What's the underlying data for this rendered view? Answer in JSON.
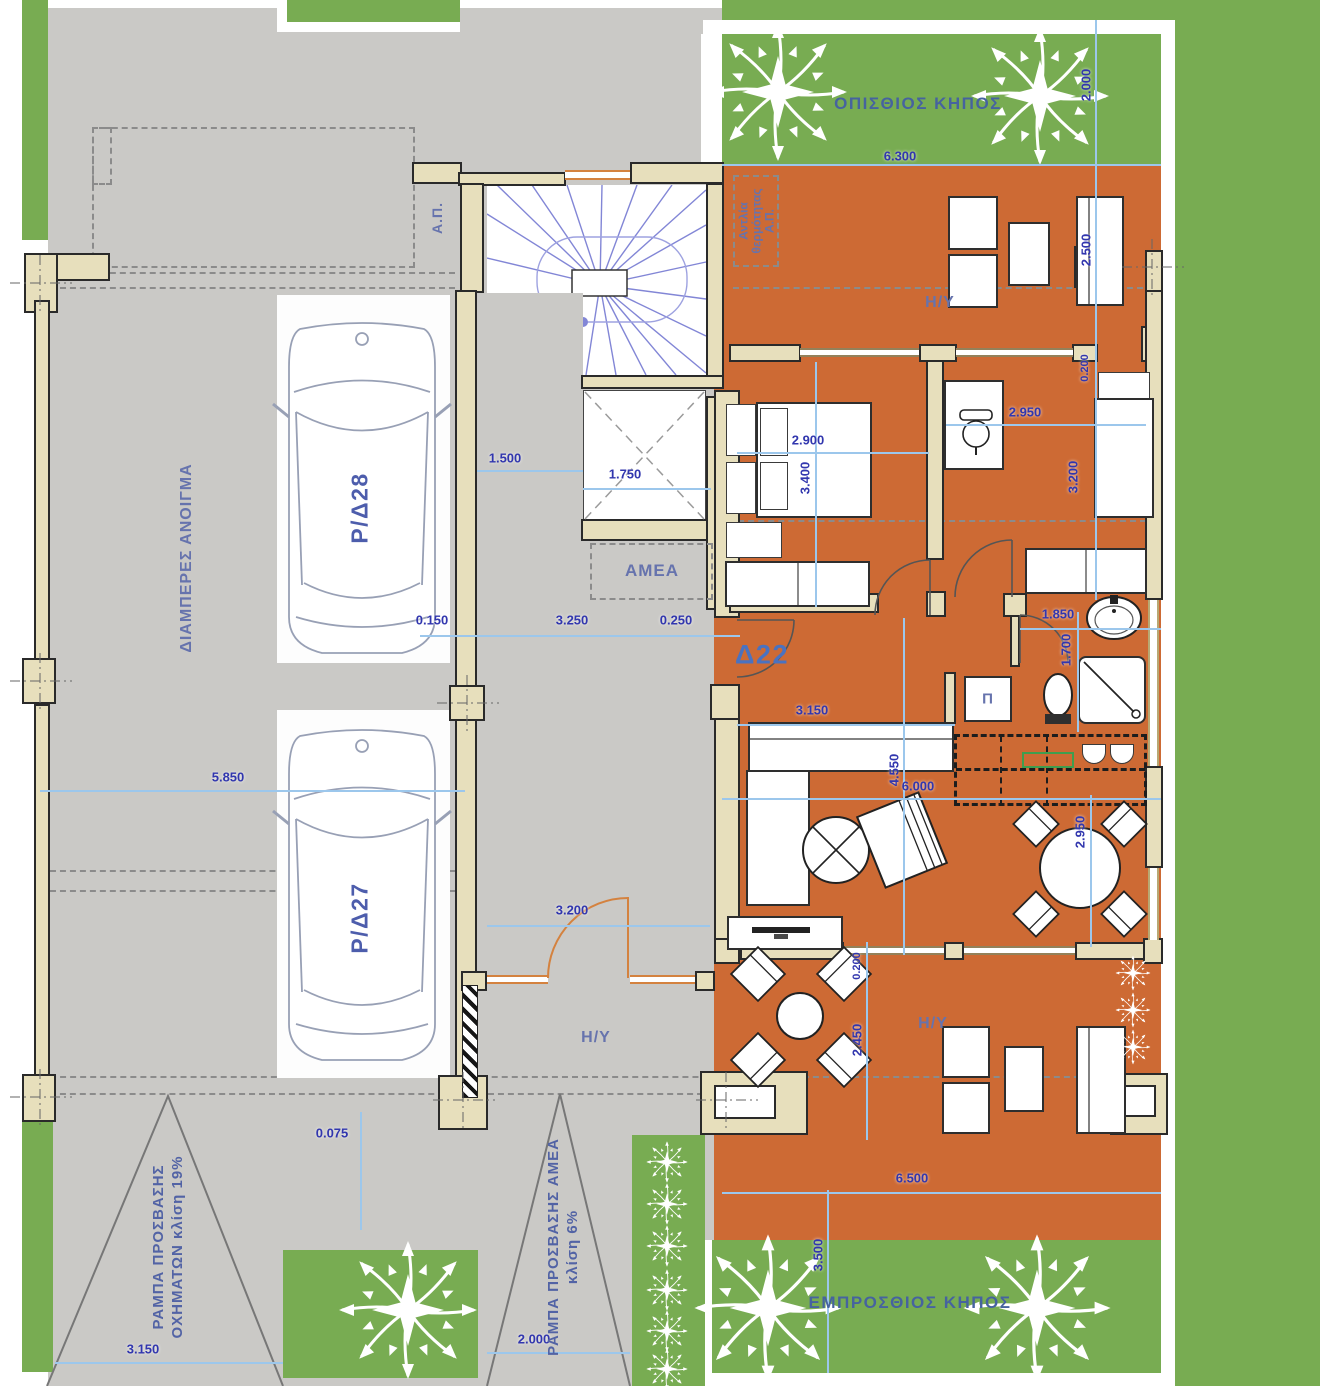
{
  "labels": {
    "back_garden": "ΟΠΙΣΘΙΟΣ ΚΗΠΟΣ",
    "front_garden": "ΕΜΠΡΟΣΘΙΟΣ ΚΗΠΟΣ",
    "through_opening": "ΔΙΑΜΠΕΡΕΣ ΑΝΟΙΓΜΑ",
    "vehicle_ramp_1": "ΡΑΜΠΑ ΠΡΟΣΒΑΣΗΣ",
    "vehicle_ramp_2": "ΟΧΗΜΑΤΩΝ κλίση 19%",
    "amea_ramp_1": "ΡΑΜΠΑ ΠΡΟΣΒΑΣΗΣ ΑΜΕΑ",
    "amea_ramp_2": "κλίση 6%",
    "heat_pump_1": "Αντλία",
    "heat_pump_2": "θερμότητας",
    "heat_pump_3": "Α.Π.",
    "ap": "Α.Π.",
    "amea": "AMEA",
    "hy": "Η/Υ",
    "pi": "Π",
    "apartment": "Δ22",
    "parking_1": "P/Δ28",
    "parking_2": "P/Δ27"
  },
  "dimensions": {
    "garden_top_width": "6.300",
    "garden_top_depth": "2.000",
    "terrace_top_depth": "2.500",
    "wall_offset_top": "0.200",
    "bedroom2_width": "2.950",
    "bedroom1_width": "2.900",
    "bedroom1_depth": "3.400",
    "bedroom2_depth": "3.200",
    "stair_width": "1.500",
    "elevator_width": "1.750",
    "wall_150": "0.150",
    "corridor_width": "3.250",
    "wall_250": "0.250",
    "bath_width": "1.850",
    "bath_depth": "1.700",
    "sofa_width": "3.150",
    "living_depth": "4.550",
    "living_width": "6.000",
    "dining_depth": "2.950",
    "garage_width": "5.850",
    "entry_width": "3.200",
    "step_height": "0.075",
    "terrace_offset": "0.200",
    "terrace_depth": "2.450",
    "terrace_width": "6.500",
    "front_garden_depth": "3.500",
    "vehicle_ramp_width": "3.150",
    "amea_ramp_width": "2.000"
  },
  "colors": {
    "floor_orange": "#cd6a34",
    "garden_green": "#78ac52",
    "paving_gray": "#cac9c6",
    "wall_tan": "#e7dfbc",
    "dim_text_blue": "#3136ae",
    "dim_line_blue": "#9cc7ec",
    "label_blue": "#46639f",
    "door_orange": "#d4823f",
    "stair_purple": "#8286d6"
  }
}
